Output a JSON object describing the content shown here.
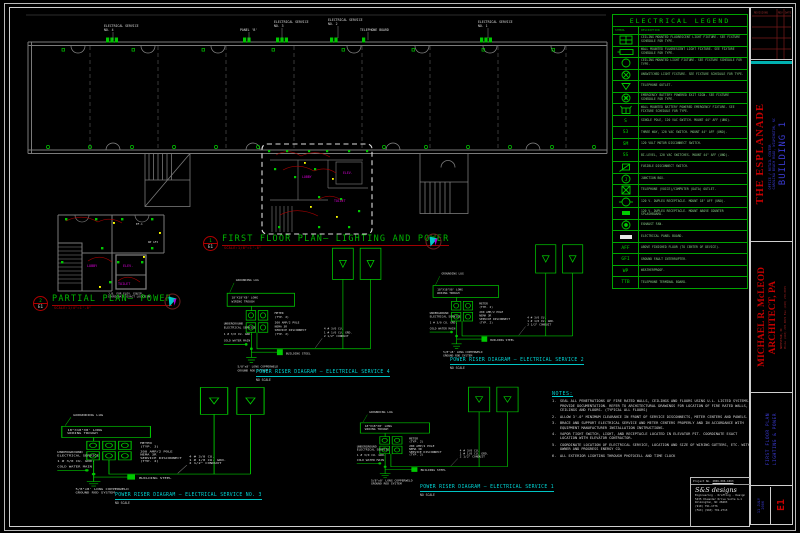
{
  "drawing": {
    "plan_title": "FIRST FLOOR PLAN— LIGHTING AND POWER",
    "plan_scale": "SCALE:1/8\"=1'-0\"",
    "plan_tag_num": "1",
    "plan_tag_sheet": "E1",
    "partial_title": "PARTIAL PLAN— POWER",
    "partial_scale": "SCALE:1/4\"=1'-0\"",
    "partial_tag_num": "2",
    "partial_tag_sheet": "E1",
    "callouts": [
      {
        "l1": "ELECTRICAL SERVICE",
        "l2": "NO. 4"
      },
      {
        "l1": "PANEL 'B'",
        "l2": ""
      },
      {
        "l1": "ELECTRICAL SERVICE",
        "l2": "NO. 3"
      },
      {
        "l1": "ELECTRICAL SERVICE",
        "l2": "NO. 2"
      },
      {
        "l1": "TELEPHONE BOARD",
        "l2": ""
      },
      {
        "l1": "ELECTRICAL SERVICE",
        "l2": "NO. 1"
      }
    ],
    "detail_labels": {
      "lobby": "LOBBY",
      "elev": "ELEV.",
      "toilet": "TOILET"
    }
  },
  "partial": {
    "room_lobby": "LOBBY",
    "room_elev": "ELEV.",
    "room_toilet": "TOILET",
    "tag_ef": "EF-1",
    "tag_wp": "WP GFI",
    "note1": "J.B. FOR ELEV. EQUIP.",
    "note2": "COORDINATE EXACT LOCATION"
  },
  "risers": [
    {
      "title": "POWER RISER DIAGRAM — ELECTRICAL SERVICE 4",
      "scale": "NO SCALE",
      "meters": 2,
      "meter_typ": "(TYP. 2)"
    },
    {
      "title": "POWER RISER DIAGRAM — ELECTRICAL SERVICE 2",
      "scale": "NO SCALE",
      "meters": 2,
      "meter_typ": "(TYP. 2)"
    },
    {
      "title": "POWER RISER DIAGRAM — ELECTRICAL SERVICE NO. 3",
      "scale": "NO SCALE",
      "meters": 3,
      "meter_typ": "(TYP. 3)"
    },
    {
      "title": "POWER RISER DIAGRAM — ELECTRICAL SERVICE 1",
      "scale": "NO SCALE",
      "meters": 2,
      "meter_typ": "(TYP. 2)"
    }
  ],
  "riser_labels": {
    "grounding_lug": "GROUNDING LUG",
    "trough1": "18\"X18\"X8' LONG",
    "trough2": "WIRING TROUGH",
    "meter_word": "METER",
    "disconnect_lines": [
      "200 AMP/2 POLE",
      "NEMA 3R",
      "SERVICE DISCONNECT",
      "(TYP. 2)"
    ],
    "conduit_lines": [
      "4 # 3/0 CU.",
      "1 # 1/0 CU. GRD.",
      "2 1/2\" CONDUIT"
    ],
    "grd": "1 # 3/0 CU. GRD.",
    "building_steel": "BUILDING STEEL",
    "rod1": "5/8\"x8' LONG COPPERWELD",
    "rod2": "GROUND ROD SYSTEM",
    "cold_water": "COLD WATER MAIN",
    "underground1": "UNDERGROUND",
    "underground2": "ELECTRICAL SERVICE"
  },
  "legend": {
    "title": "ELECTRICAL LEGEND",
    "col_symbol": "SYMBOL",
    "col_desc": "DESCRIPTION",
    "rows": [
      {
        "glyph": "recessed-fluorescent-icon",
        "desc": "CEILING MOUNTED FLUORESCENT LIGHT FIXTURE. SEE FIXTURE SCHEDULE FOR TYPE."
      },
      {
        "glyph": "wall-fluorescent-icon",
        "desc": "WALL MOUNTED FLUORESCENT LIGHT FIXTURE. SEE FIXTURE SCHEDULE FOR TYPE."
      },
      {
        "glyph": "ceiling-fixture-icon",
        "desc": "CEILING MOUNTED LIGHT FIXTURE.  SEE FIXTURE SCHEDULE FOR TYPE."
      },
      {
        "glyph": "unswitched-fixture-icon",
        "desc": "UNSWITCHED LIGHT FIXTURE. SEE FIXTURE SCHEDULE FOR TYPE."
      },
      {
        "glyph": "telephone-outlet-icon",
        "desc": "TELEPHONE OUTLET."
      },
      {
        "glyph": "exit-sign-icon",
        "desc": "EMERGENCY BATTERY POWERED EXIT SIGN. SEE FIXTURE SCHEDULE FOR TYPE."
      },
      {
        "glyph": "battery-emergency-icon",
        "desc": "WALL MOUNTED BATTERY POWERED EMERGENCY FIXTURE- SEE FIXTURE SCHEDULE FOR TYPE."
      },
      {
        "glyph": "switch-text",
        "sym": "S",
        "desc": "SINGLE POLE, 120 VAC SWITCH. MOUNT 44\" AFF (UNO)."
      },
      {
        "glyph": "switch-text",
        "sym": "S3",
        "desc": "THREE WAY, 120 VAC SWITCH. MOUNT 44\" AFF (UNO)."
      },
      {
        "glyph": "switch-text",
        "sym": "SM",
        "desc": "120 VOLT MOTOR DISCONNECT SWITCH."
      },
      {
        "glyph": "switch-text",
        "sym": "SS",
        "desc": "BI-LEVEL, 120 VAC SWITCHES. MOUNT 44\" AFF (UNO)."
      },
      {
        "glyph": "fusible-disconnect-icon",
        "desc": "FUSIBLE DISCONNECT SWITCH."
      },
      {
        "glyph": "junction-box-icon",
        "desc": "JUNCTION BOX."
      },
      {
        "glyph": "tel-data-outlet-icon",
        "desc": "TELEPHONE (VOICE)/COMPUTER (DATA) OUTLET."
      },
      {
        "glyph": "duplex-receptacle-icon",
        "desc": "120 V. DUPLEX RECEPTACLE. MOUNT 18\" AFF (UNO)."
      },
      {
        "glyph": "duplex-counter-icon",
        "desc": "120 V. DUPLEX RECEPTACLE. MOUNT ABOVE COUNTER SPLASHBOARD."
      },
      {
        "glyph": "exhaust-fan-icon",
        "desc": "EXHAUST FAN."
      },
      {
        "glyph": "panel-board-icon",
        "desc": "ELECTRICAL PANEL BOARD."
      },
      {
        "glyph": "switch-text",
        "sym": "AFF",
        "desc": "ABOVE FINISHED FLOOR (TO CENTER OF DEVICE)."
      },
      {
        "glyph": "switch-text",
        "sym": "GFI",
        "desc": "GROUND FAULT INTERRUPTER."
      },
      {
        "glyph": "switch-text",
        "sym": "WP",
        "desc": "WEATHERPROOF."
      },
      {
        "glyph": "switch-text",
        "sym": "TTB",
        "desc": "TELEPHONE TERMINAL BOARD."
      }
    ]
  },
  "notes": {
    "title": "NOTES:",
    "items": [
      "SEAL ALL PENETRATIONS OF FIRE RATED WALLS, CEILINGS AND FLOORS USING U.L. LISTED SYSTEMS.  PROVIDE DOCUMENTATION.  REFER TO ARCHITECTURAL DRAWINGS FOR LOCATION OF FIRE RATED WALLS, CEILINGS AND FLOORS.  (TYPICAL ALL FLOORS)",
      "ALLOW 3'-0\" MINIMUM CLEARANCE IN FRONT OF SERVICE DISCONNECTS, METER CENTERS AND PANELS.",
      "BRACE AND SUPPORT ELECTRICAL SERVICE AND METER CENTERS PROPERLY AND IN ACCORDANCE WITH EQUIPMENT MANUFACTURER INSTALLATION INSTRUCTIONS.",
      "VAPOR TIGHT SWITCH, LIGHT, AND RECEPTACLE LOCATED IN ELEVATOR PIT. COORDINATE EXACT LOCATION WITH ELEVATOR CONTRACTOR.",
      "COORDINATE LOCATION OF ELECTRICAL SERVICE, LOCATION AND SIZE OF WIRING GUTTERS, ETC. WITH OWNER AND PROGRESS ENERGY CO.",
      "ALL EXTERIOR LIGHTING THROUGH PHOTOCELL AND TIME CLOCK"
    ]
  },
  "titleblock": {
    "revisions": "REVISIONS",
    "col_rev": "REV",
    "col_date": "DATE",
    "project_name": "THE ESPLANADE",
    "project_sub1": "OFFICE / RETAIL CENTER",
    "project_sub2": "CAROLINA BEACH ROAD, WILMINGTON, NC",
    "building": "BUILDING 1",
    "architect_line1": "MICHAEL R. McLEOD",
    "architect_line2": "ARCHITECT, PA",
    "architect_addr1": "HAMPSTEAD, NC",
    "architect_addr2": "Phone (910) 270-0076  Fax (910) 270-0075",
    "sheet_title_line1": "FIRST FLOOR PLAN",
    "sheet_title_line2": "LIGHTING & POWER",
    "date_line1": "11 JULY",
    "date_line2": "2006",
    "sheet_no": "E1"
  },
  "firm": {
    "project_no_label": "Project No.",
    "project_no": "2006-006-1063",
    "name": "S&S designs",
    "tagline": "Engineering - Drafting - Design",
    "addr1": "5235 Oleander Drive  Suite G-1",
    "addr2": "Wilmington, NC 28403",
    "phone": "(910) 791-1776",
    "fax": "(FAX) (910) 791-2713"
  }
}
